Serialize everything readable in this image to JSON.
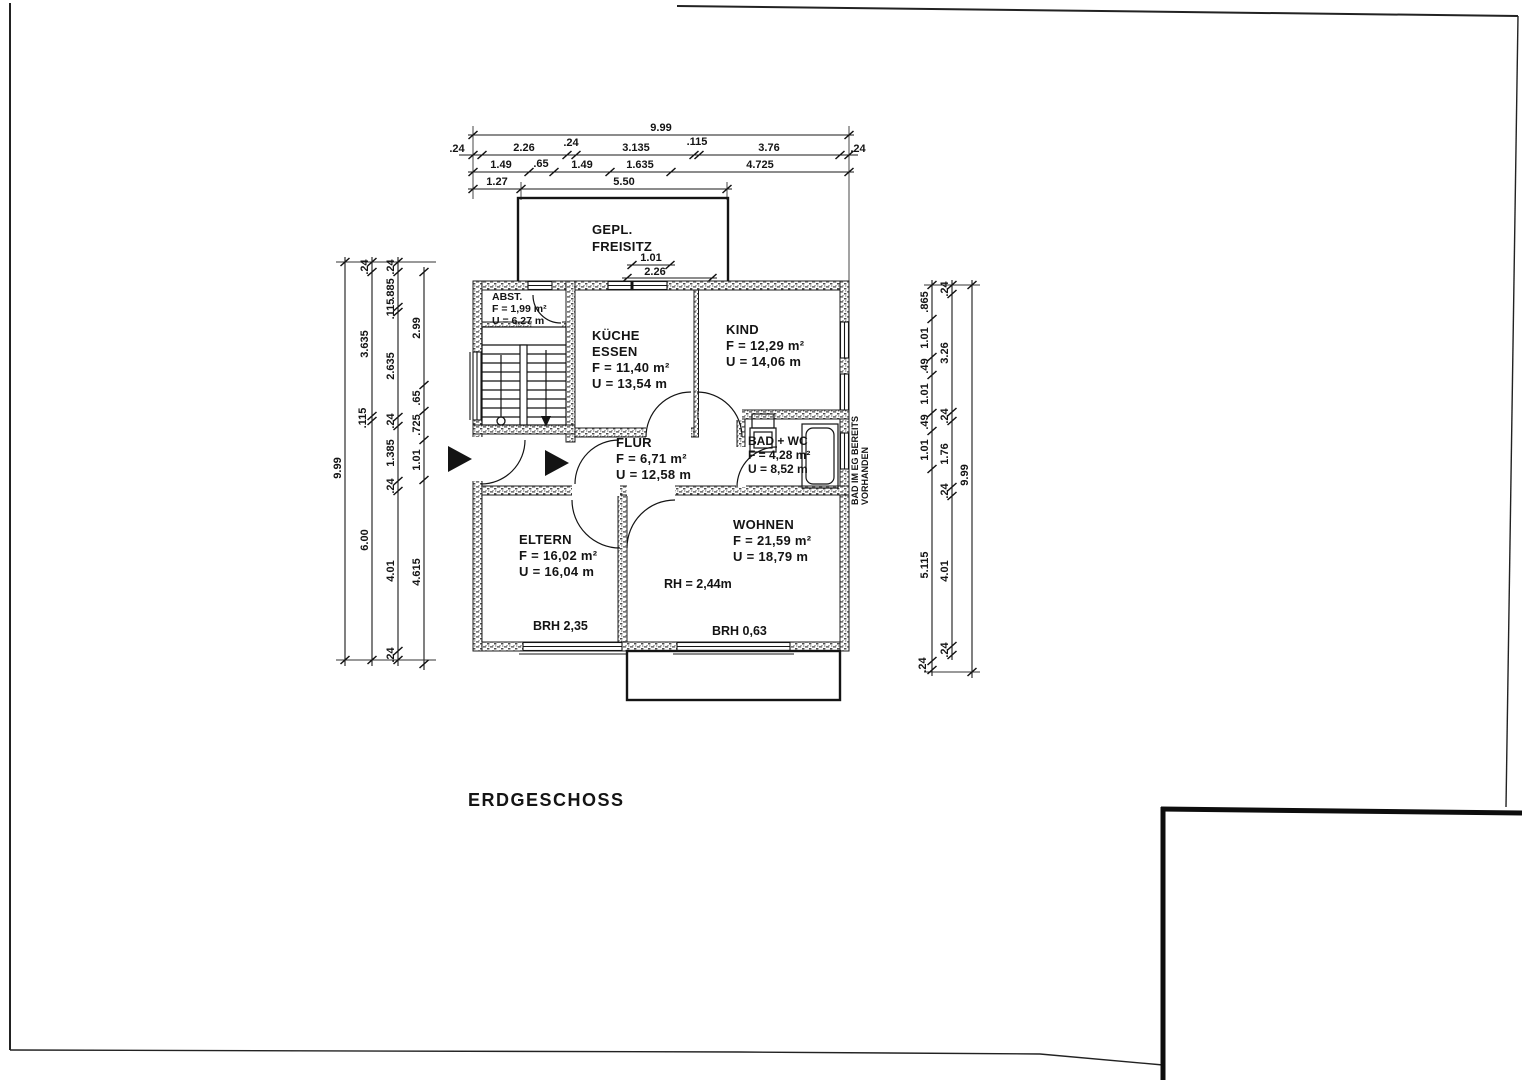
{
  "title": "ERDGESCHOSS",
  "freisitz": {
    "line1": "GEPL.",
    "line2": "FREISITZ",
    "dim1": "1.01",
    "dim2": "2.26"
  },
  "rooms": {
    "abst": {
      "name": "ABST.",
      "area": "F = 1,99 m²",
      "perimeter": "U = 6,27 m"
    },
    "kueche": {
      "name1": "KÜCHE",
      "name2": "ESSEN",
      "area": "F = 11,40 m²",
      "perimeter": "U = 13,54 m"
    },
    "kind": {
      "name": "KIND",
      "area": "F = 12,29 m²",
      "perimeter": "U = 14,06 m"
    },
    "flur": {
      "name": "FLUR",
      "area": "F = 6,71 m²",
      "perimeter": "U = 12,58 m"
    },
    "bad": {
      "name": "BAD + WC",
      "area": "F = 4,28 m²",
      "perimeter": "U = 8,52 m"
    },
    "eltern": {
      "name": "ELTERN",
      "area": "F = 16,02 m²",
      "perimeter": "U = 16,04 m"
    },
    "wohnen": {
      "name": "WOHNEN",
      "area": "F = 21,59 m²",
      "perimeter": "U = 18,79 m"
    }
  },
  "annotations": {
    "room_height": "RH = 2,44m",
    "brh_eltern": "BRH 2,35",
    "brh_wohnen": "BRH 0,63",
    "note_line1": "BAD IM EG BEREITS",
    "note_line2": "VORHANDEN"
  },
  "dims": {
    "top1": [
      "9.99"
    ],
    "top2": [
      ".24",
      "2.26",
      ".24",
      "3.135",
      ".115",
      "3.76",
      ".24"
    ],
    "top3": [
      "1.49",
      ".65",
      "1.49",
      "1.635",
      "4.725"
    ],
    "top4": [
      "1.27",
      "5.50"
    ],
    "left1": [
      "9.99"
    ],
    "left2": [
      ".24",
      "3.635",
      ".115",
      "6.00"
    ],
    "left3": [
      ".24",
      ".885",
      ".115",
      "2.635",
      ".24",
      "1.385",
      ".24",
      "4.01",
      ".24"
    ],
    "left4": [
      "2.99",
      ".65",
      ".725",
      "1.01",
      "4.615"
    ],
    "right1": [
      ".865",
      "1.01",
      ".49",
      "1.01",
      ".49",
      "1.01",
      "5.115",
      ".24"
    ],
    "right2": [
      ".24",
      "3.26",
      ".24",
      "1.76",
      ".24",
      "4.01",
      ".24"
    ],
    "right3": [
      "9.99"
    ]
  }
}
